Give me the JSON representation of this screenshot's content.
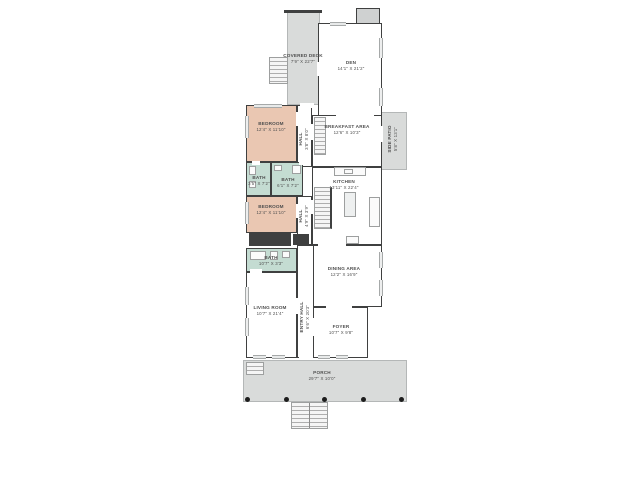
{
  "colors": {
    "wall": "#3f4040",
    "room": "#ffffff",
    "bedroom": "#eac7b2",
    "bath": "#c4dcd2",
    "outdoor": "#d9dbda",
    "text": "#4f4f4f"
  },
  "rooms": {
    "covered_deck": {
      "name": "COVERED DECK",
      "dims": "7'9\" X 22'7\""
    },
    "den": {
      "name": "DEN",
      "dims": "14'1\" X 21'2\""
    },
    "bedroom1": {
      "name": "BEDROOM",
      "dims": "12'4\" X 11'10\""
    },
    "hall1": {
      "name": "HALL",
      "dims": "3'8\" X 8'0\""
    },
    "breakfast_area": {
      "name": "BREAKFAST AREA",
      "dims": "12'6\" X 10'3\""
    },
    "side_patio": {
      "name": "SIDE PATIO",
      "dims": "5'8\" X 13'1\""
    },
    "bath1": {
      "name": "BATH",
      "dims": "3'5\" X 7'2\""
    },
    "bath2": {
      "name": "BATH",
      "dims": "6'1\" X 7'2\""
    },
    "kitchen": {
      "name": "KITCHEN",
      "dims": "13'11\" X 22'4\""
    },
    "bedroom2": {
      "name": "BEDROOM",
      "dims": "12'4\" X 11'10\""
    },
    "hall2": {
      "name": "HALL",
      "dims": "4'9\" X 3'9\""
    },
    "bath3": {
      "name": "BATH",
      "dims": "10'7\" X 3'3\""
    },
    "dining_area": {
      "name": "DINING AREA",
      "dims": "12'2\" X 16'9\""
    },
    "living_room": {
      "name": "LIVING ROOM",
      "dims": "10'7\" X 21'4\""
    },
    "entry_hall": {
      "name": "ENTRY HALL",
      "dims": "6'6\" X 20'3\""
    },
    "foyer": {
      "name": "FOYER",
      "dims": "10'7\" X 9'8\""
    },
    "porch": {
      "name": "PORCH",
      "dims": "29'7\" X 10'0\""
    }
  }
}
